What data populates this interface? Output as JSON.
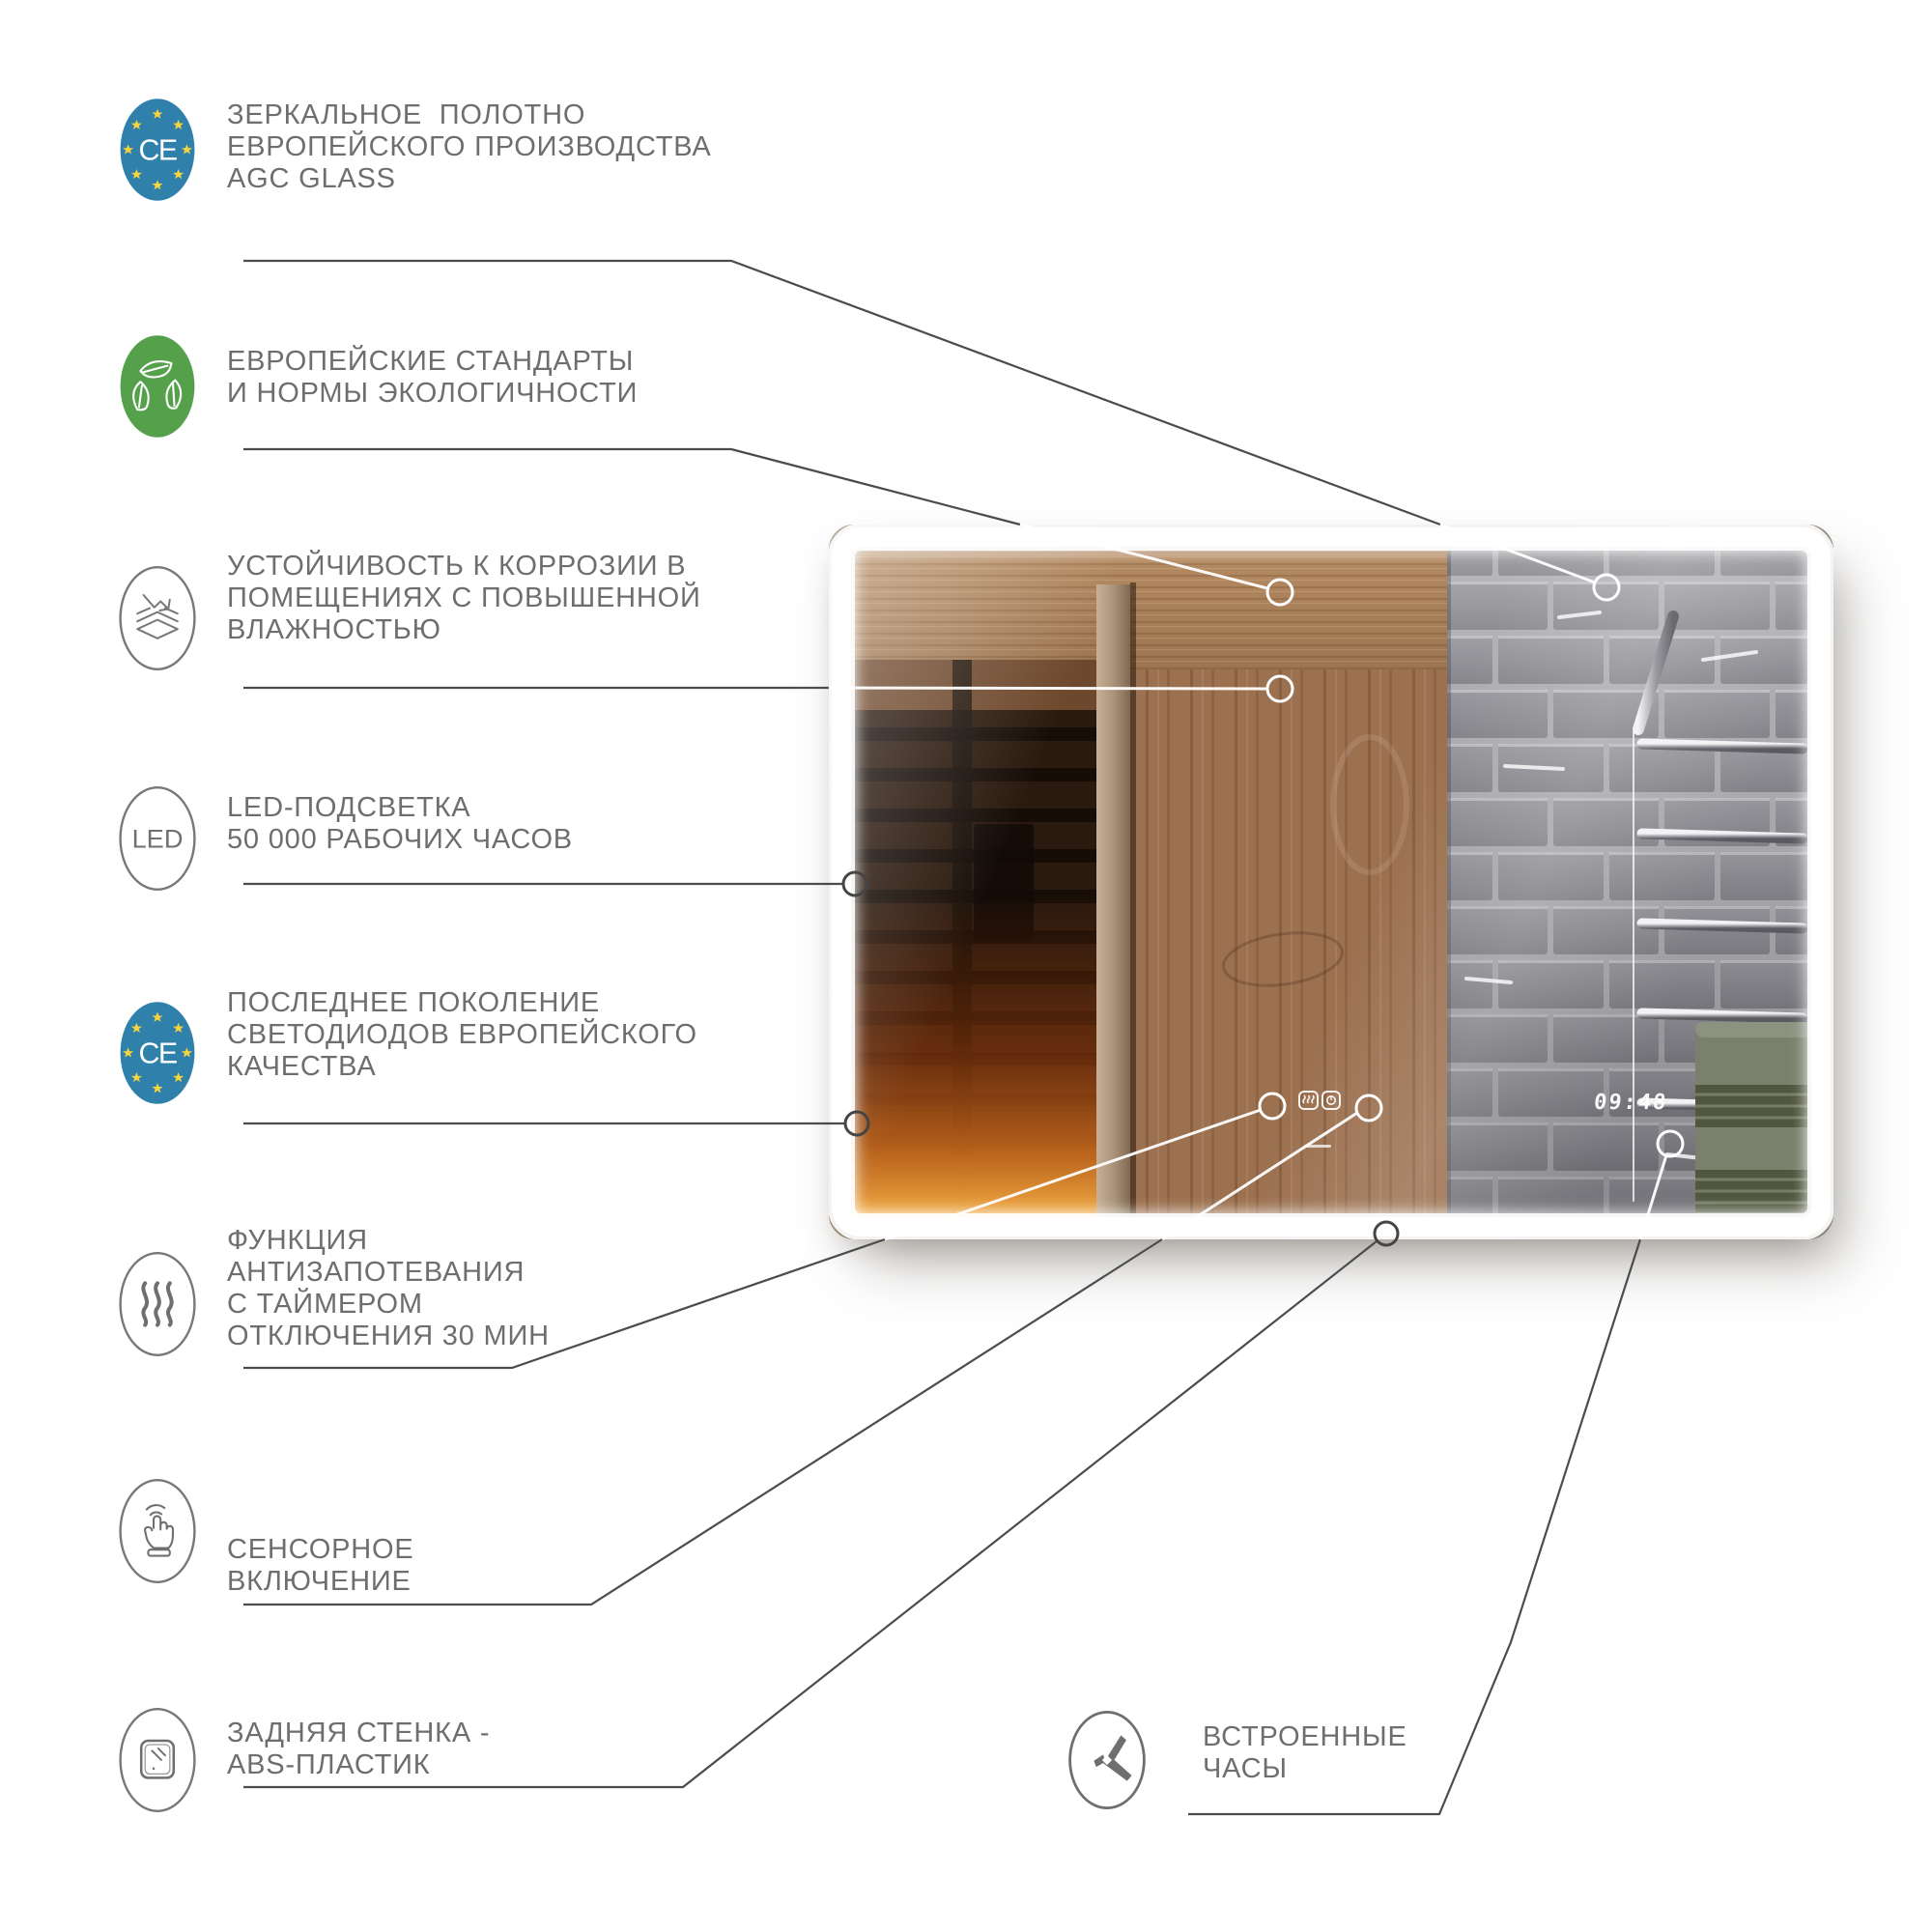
{
  "page": {
    "background": "#ffffff",
    "language": "ru",
    "type": "product-infographic-led-mirror"
  },
  "colors": {
    "text_gray": "#6e6e6e",
    "line_gray": "#4c4c4c",
    "ce_blue": "#2f80ab",
    "eco_green": "#55a14b",
    "star_yellow": "#f6d43f",
    "led_white": "#ffffff",
    "tile_gray": "#8b8a90",
    "wood_brown": "#9c7150",
    "sauna_glow_orange": "#e89a33",
    "towel_green": "#79806c"
  },
  "features": [
    {
      "icon": "ce-badge-icon",
      "badge_text": "CE",
      "lines": [
        "ЗЕРКАЛЬНОЕ  ПОЛОТНО",
        "ЕВРОПЕЙСКОГО ПРОИЗВОДСТВА",
        "AGC GLASS"
      ]
    },
    {
      "icon": "eco-leaves-icon",
      "lines": [
        "ЕВРОПЕЙСКИЕ СТАНДАРТЫ",
        "И НОРМЫ ЭКОЛОГИЧНОСТИ"
      ]
    },
    {
      "icon": "corrosion-resistance-icon",
      "lines": [
        "УСТОЙЧИВОСТЬ К КОРРОЗИИ В",
        "ПОМЕЩЕНИЯХ С ПОВЫШЕННОЙ",
        "ВЛАЖНОСТЬЮ"
      ]
    },
    {
      "icon": "led-icon",
      "led_text": "LED",
      "lines": [
        "LED-ПОДСВЕТКА",
        "50 000 РАБОЧИХ ЧАСОВ"
      ]
    },
    {
      "icon": "ce-badge-icon",
      "badge_text": "CE",
      "lines": [
        "ПОСЛЕДНЕЕ ПОКОЛЕНИЕ",
        "СВЕТОДИОДОВ ЕВРОПЕЙСКОГО",
        "КАЧЕСТВА"
      ]
    },
    {
      "icon": "antifog-icon",
      "lines": [
        "ФУНКЦИЯ",
        "АНТИЗАПОТЕВАНИЯ",
        "С ТАЙМЕРОМ",
        "ОТКЛЮЧЕНИЯ 30 МИН"
      ]
    },
    {
      "icon": "touch-icon",
      "lines": [
        "СЕНСОРНОЕ",
        "ВКЛЮЧЕНИЕ"
      ]
    },
    {
      "icon": "abs-back-icon",
      "lines": [
        "ЗАДНЯЯ СТЕНКА -",
        "ABS-ПЛАСТИК"
      ]
    },
    {
      "icon": "clock-icon",
      "lines": [
        "ВСТРОЕННЫЕ",
        "ЧАСЫ"
      ]
    }
  ],
  "mirror": {
    "clock_time": "09:48",
    "scene": "reflection of sauna interior, wooden wall and gray subway tiles with chrome towel rail and green towel",
    "led_border": true,
    "touch_controls": [
      "antifog-button-icon",
      "timer-button-icon"
    ]
  }
}
